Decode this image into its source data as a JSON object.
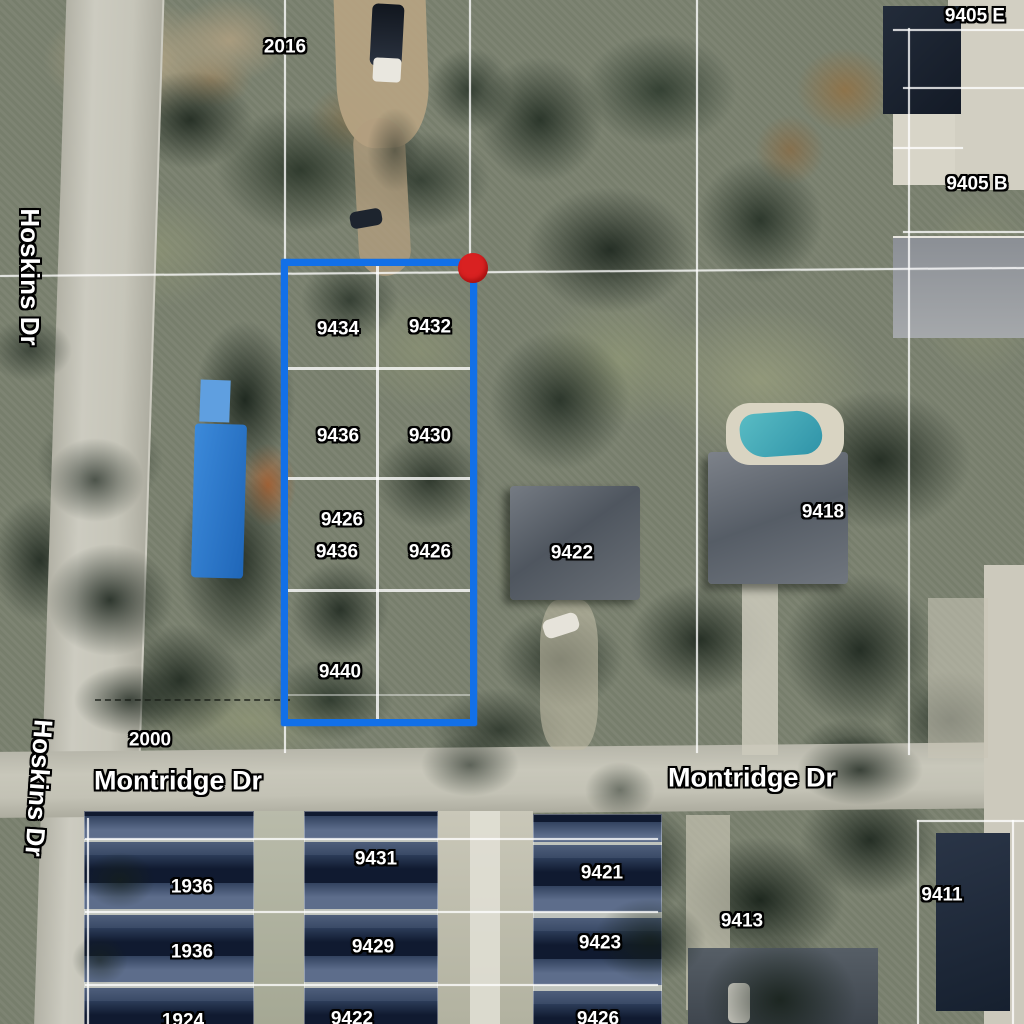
{
  "map": {
    "description": "Aerial satellite parcel map with highlighted lot assemblage",
    "streets": [
      "Hoskins Dr",
      "Montridge Dr"
    ],
    "highlight": {
      "outline_color": "#1270e8",
      "marker_color": "#d92121",
      "x": 281,
      "y": 259,
      "width": 196,
      "height": 467,
      "marker": {
        "x": 473,
        "y": 268
      }
    },
    "labels": [
      {
        "text": "2016",
        "x": 285,
        "y": 47,
        "size": 19,
        "rot": 0,
        "kind": "parcel-number"
      },
      {
        "text": "9405 E",
        "x": 975,
        "y": 16,
        "size": 19,
        "rot": 0,
        "kind": "parcel-number"
      },
      {
        "text": "9405 B",
        "x": 977,
        "y": 184,
        "size": 19,
        "rot": 0,
        "kind": "parcel-number"
      },
      {
        "text": "Hoskins Dr",
        "x": 30,
        "y": 277,
        "size": 26,
        "rot": 90,
        "kind": "street-name"
      },
      {
        "text": "Hoskins Dr",
        "x": 39,
        "y": 788,
        "size": 26,
        "rot": 94,
        "kind": "street-name"
      },
      {
        "text": "9434",
        "x": 338,
        "y": 329,
        "size": 19,
        "rot": 0,
        "kind": "parcel-number"
      },
      {
        "text": "9432",
        "x": 430,
        "y": 327,
        "size": 19,
        "rot": 0,
        "kind": "parcel-number"
      },
      {
        "text": "9436",
        "x": 338,
        "y": 436,
        "size": 19,
        "rot": 0,
        "kind": "parcel-number"
      },
      {
        "text": "9430",
        "x": 430,
        "y": 436,
        "size": 19,
        "rot": 0,
        "kind": "parcel-number"
      },
      {
        "text": "9426",
        "x": 342,
        "y": 520,
        "size": 19,
        "rot": 0,
        "kind": "parcel-number"
      },
      {
        "text": "9436",
        "x": 337,
        "y": 552,
        "size": 19,
        "rot": 0,
        "kind": "parcel-number"
      },
      {
        "text": "9426",
        "x": 430,
        "y": 552,
        "size": 19,
        "rot": 0,
        "kind": "parcel-number"
      },
      {
        "text": "9422",
        "x": 572,
        "y": 553,
        "size": 19,
        "rot": 0,
        "kind": "parcel-number"
      },
      {
        "text": "9418",
        "x": 823,
        "y": 512,
        "size": 19,
        "rot": 0,
        "kind": "parcel-number"
      },
      {
        "text": "9440",
        "x": 340,
        "y": 672,
        "size": 19,
        "rot": 0,
        "kind": "parcel-number"
      },
      {
        "text": "2000",
        "x": 150,
        "y": 740,
        "size": 19,
        "rot": 0,
        "kind": "parcel-number"
      },
      {
        "text": "Montridge Dr",
        "x": 178,
        "y": 781,
        "size": 27,
        "rot": 0,
        "kind": "street-name"
      },
      {
        "text": "Montridge Dr",
        "x": 752,
        "y": 778,
        "size": 27,
        "rot": 0,
        "kind": "street-name"
      },
      {
        "text": "1936",
        "x": 192,
        "y": 887,
        "size": 19,
        "rot": 0,
        "kind": "parcel-number"
      },
      {
        "text": "9431",
        "x": 376,
        "y": 859,
        "size": 19,
        "rot": 0,
        "kind": "parcel-number"
      },
      {
        "text": "1936",
        "x": 192,
        "y": 952,
        "size": 19,
        "rot": 0,
        "kind": "parcel-number"
      },
      {
        "text": "9429",
        "x": 373,
        "y": 947,
        "size": 19,
        "rot": 0,
        "kind": "parcel-number"
      },
      {
        "text": "1924",
        "x": 183,
        "y": 1021,
        "size": 19,
        "rot": 0,
        "kind": "parcel-number"
      },
      {
        "text": "9422",
        "x": 352,
        "y": 1019,
        "size": 19,
        "rot": 0,
        "kind": "parcel-number"
      },
      {
        "text": "9426",
        "x": 598,
        "y": 1019,
        "size": 19,
        "rot": 0,
        "kind": "parcel-number"
      },
      {
        "text": "9421",
        "x": 602,
        "y": 873,
        "size": 19,
        "rot": 0,
        "kind": "parcel-number"
      },
      {
        "text": "9423",
        "x": 600,
        "y": 943,
        "size": 19,
        "rot": 0,
        "kind": "parcel-number"
      },
      {
        "text": "9413",
        "x": 742,
        "y": 921,
        "size": 19,
        "rot": 0,
        "kind": "parcel-number"
      },
      {
        "text": "9411",
        "x": 942,
        "y": 895,
        "size": 19,
        "rot": 0,
        "kind": "parcel-number"
      }
    ]
  }
}
